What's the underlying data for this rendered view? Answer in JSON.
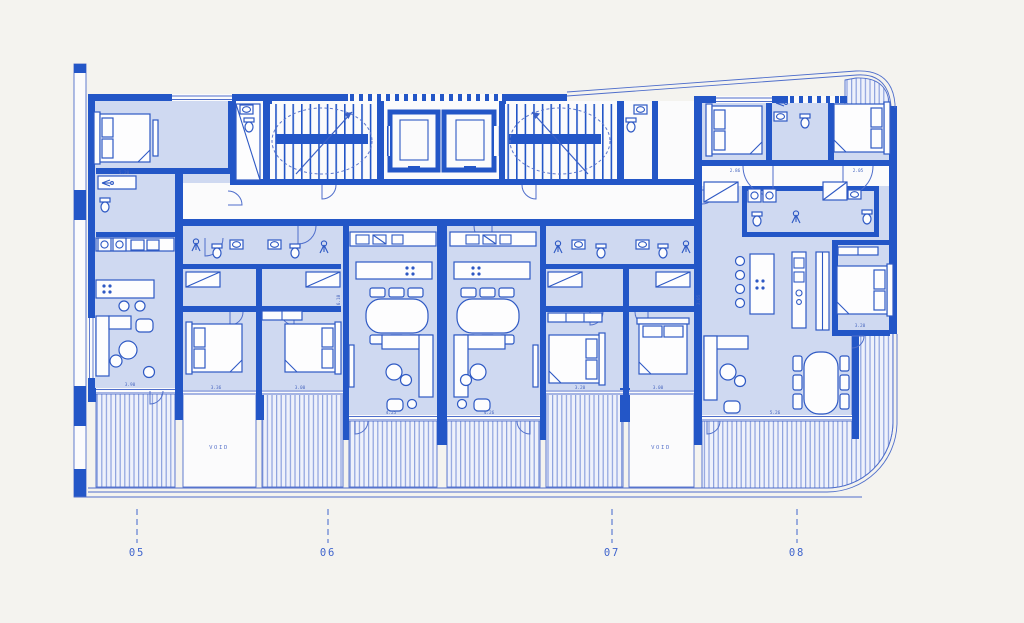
{
  "canvas": {
    "width": 1024,
    "height": 623
  },
  "palette": {
    "background": "#f4f3ef",
    "wall_blue": "#2356c7",
    "line_blue": "#3b60c6",
    "room_fill": "#cfd9f1",
    "hatch_line": "#8da2de",
    "hatch_bg": "#eef1fb",
    "label_blue": "#4065cd",
    "fixture_white": "#fdfdfe"
  },
  "units": [
    {
      "id": "unit-05",
      "label": "05"
    },
    {
      "id": "unit-06",
      "label": "06"
    },
    {
      "id": "unit-07",
      "label": "07"
    },
    {
      "id": "unit-08",
      "label": "08"
    }
  ],
  "void_labels": [
    "VOID",
    "VOID"
  ],
  "dimensions": [
    "5.20",
    "3.90",
    "3.36",
    "3.00",
    "4.25",
    "4.26",
    "3.20",
    "3.00",
    "2.86",
    "2.05",
    "3.20",
    "5.26",
    "6.10",
    "3.05"
  ]
}
